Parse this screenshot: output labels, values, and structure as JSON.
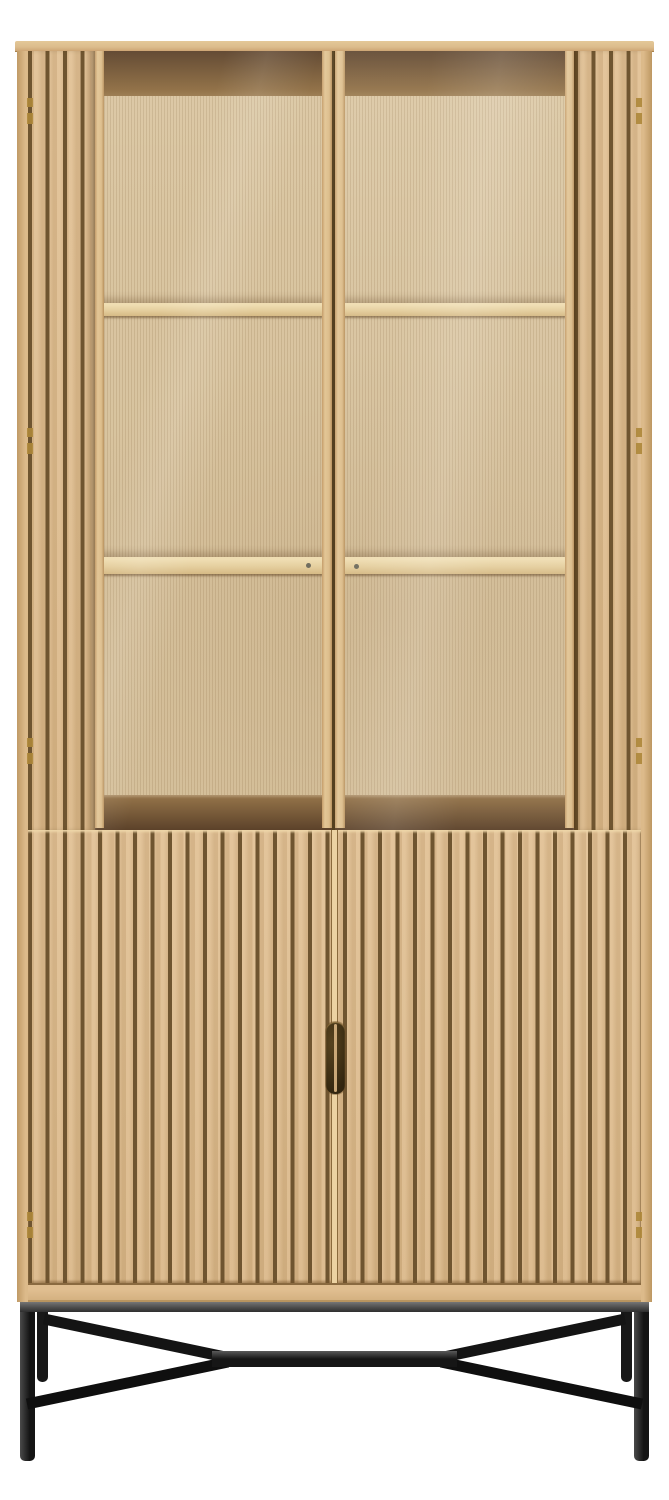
{
  "scene": {
    "type": "product-photo",
    "object": "tall oak display cabinet with vertical slat detailing",
    "upper_section": {
      "glass_doors": 2,
      "visible_shelves": 2,
      "compartment_rows": 3,
      "side_slat_panels": 2
    },
    "lower_section": {
      "slatted_doors": 2,
      "handle": "recessed dark vertical pull at center seam"
    },
    "base": {
      "material": "black metal",
      "front_legs": 2,
      "back_legs_visible": 2,
      "center_stretcher": 1,
      "diagonal_braces": 4
    },
    "hinges_visible": 8
  },
  "palette": {
    "background": "#ffffff",
    "wood": "#ddbb8c",
    "wood_light": "#e6cda3",
    "wood_edge": "#c9a471",
    "groove": "#6f5530",
    "back_panel": "#dbc7a3",
    "interior_shadow_dark": "#5c422a",
    "interior_shadow": "#8d6c41",
    "shelf": "#e5cf9f",
    "glass_sheen": "rgba(255,255,255,0.14)",
    "metal_rail": "#4c4c4c",
    "metal_dark": "#141414",
    "handle_dark": "#33260f",
    "brass": "#ad8739"
  },
  "dimensions": {
    "width": 669,
    "height": 1500
  }
}
